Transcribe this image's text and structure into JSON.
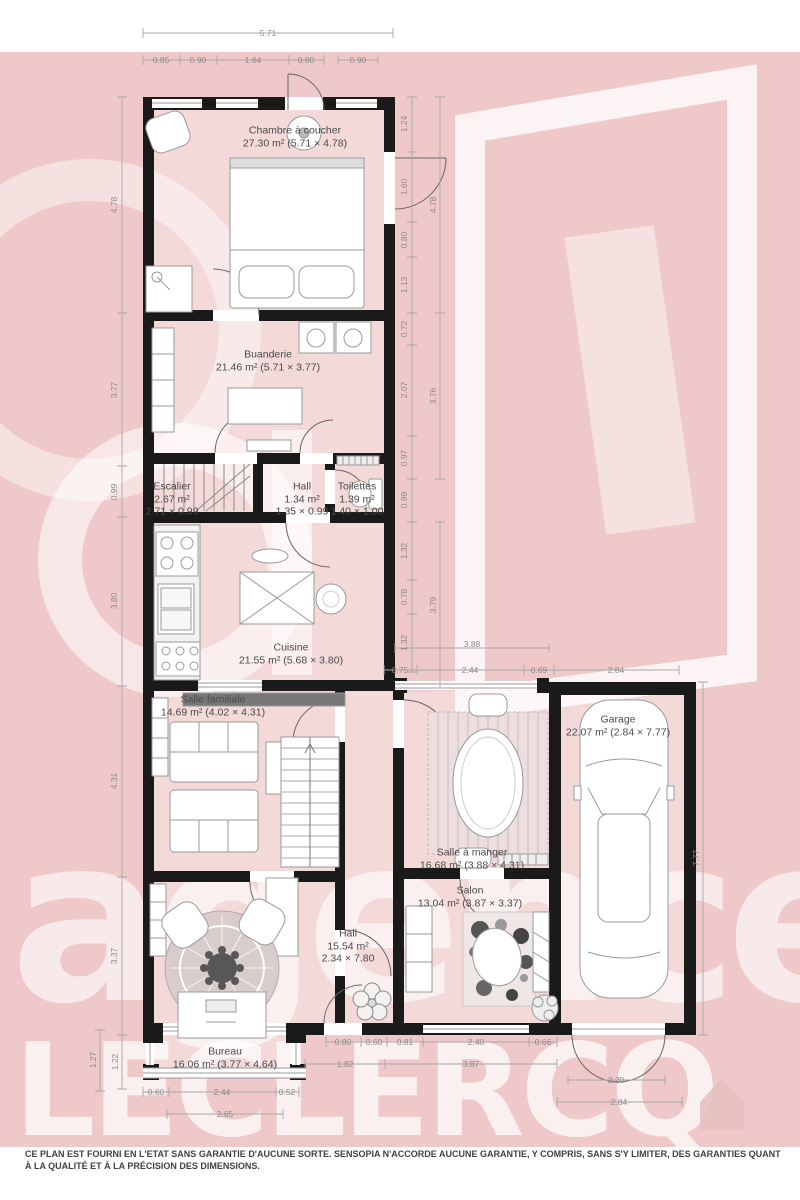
{
  "watermark": {
    "word1": "agence",
    "word2": "LECLERCQ"
  },
  "rooms": [
    {
      "name": "Chambre à coucher",
      "details": "27.30 m² (5.71 × 4.78)"
    },
    {
      "name": "Buanderie",
      "details": "21.46 m² (5.71 × 3.77)"
    },
    {
      "name": "Escalier",
      "area": "2.67 m²",
      "size": "2.71 × 0.99"
    },
    {
      "name": "Hall",
      "area": "1.34 m²",
      "size": "1.35 × 0.99"
    },
    {
      "name": "Toilettes",
      "area": "1.39 m²",
      "size": "1.40 × 1.00"
    },
    {
      "name": "Cuisine",
      "details": "21.55 m² (5.68 × 3.80)"
    },
    {
      "name": "Salle familiale",
      "details": "14.69 m² (4.02 × 4.31)"
    },
    {
      "name": "Garage",
      "details": "22.07 m² (2.84 × 7.77)"
    },
    {
      "name": "Salle à manger",
      "details": "16.68 m² (3.88 × 4.31)"
    },
    {
      "name": "Salon",
      "details": "13.04 m² (3.87 × 3.37)"
    },
    {
      "name": "Hall",
      "area": "15.54 m²",
      "size": "2.34 × 7.80"
    },
    {
      "name": "Bureau",
      "details": "16.06 m² (3.77 × 4.64)"
    }
  ],
  "dimensions": {
    "top_total": "5.71",
    "top_a": "0.85",
    "top_b": "0.90",
    "top_c": "1.64",
    "top_d": "0.80",
    "top_e": "0.90",
    "left_1": "4.78",
    "left_2": "3.77",
    "left_3": "0.99",
    "left_4": "3.80",
    "left_5": "4.31",
    "left_6": "3.37",
    "left_7": "1.27",
    "left_8": "1.22",
    "right_a": "1.24",
    "right_b": "1.60",
    "right_c": "0.80",
    "right_d": "1.13",
    "right_e": "4.78",
    "right_f": "0.72",
    "right_g": "2.07",
    "right_h": "0.97",
    "right_i": "3.76",
    "right_j": "0.99",
    "right_k": "1.32",
    "right_l": "0.78",
    "right_m": "1.32",
    "right_n": "3.79",
    "mid_total": "3.88",
    "mid_a": "0.75",
    "mid_b": "2.44",
    "mid_c": "0.69",
    "mid_d": "2.84",
    "garage_h": "7.77",
    "bot_a": "0.80",
    "bot_b": "0.60",
    "bot_c": "0.81",
    "bot_d": "2.40",
    "bot_e": "0.66",
    "bot_f": "1.82",
    "bot_g": "3.87",
    "gar_a": "2.20",
    "gar_b": "2.84",
    "bur_a": "0.60",
    "bur_b": "2.44",
    "bur_c": "0.52",
    "bur_d": "2.65"
  },
  "disclaimer": "CE PLAN EST FOURNI EN L'ETAT SANS GARANTIE D'AUCUNE SORTE. SENSOPIA N'ACCORDE AUCUNE GARANTIE, Y COMPRIS, SANS S'Y LIMITER, DES GARANTIES QUANT À LA QUALITÉ ET À LA PRÉCISION DES DIMENSIONS."
}
